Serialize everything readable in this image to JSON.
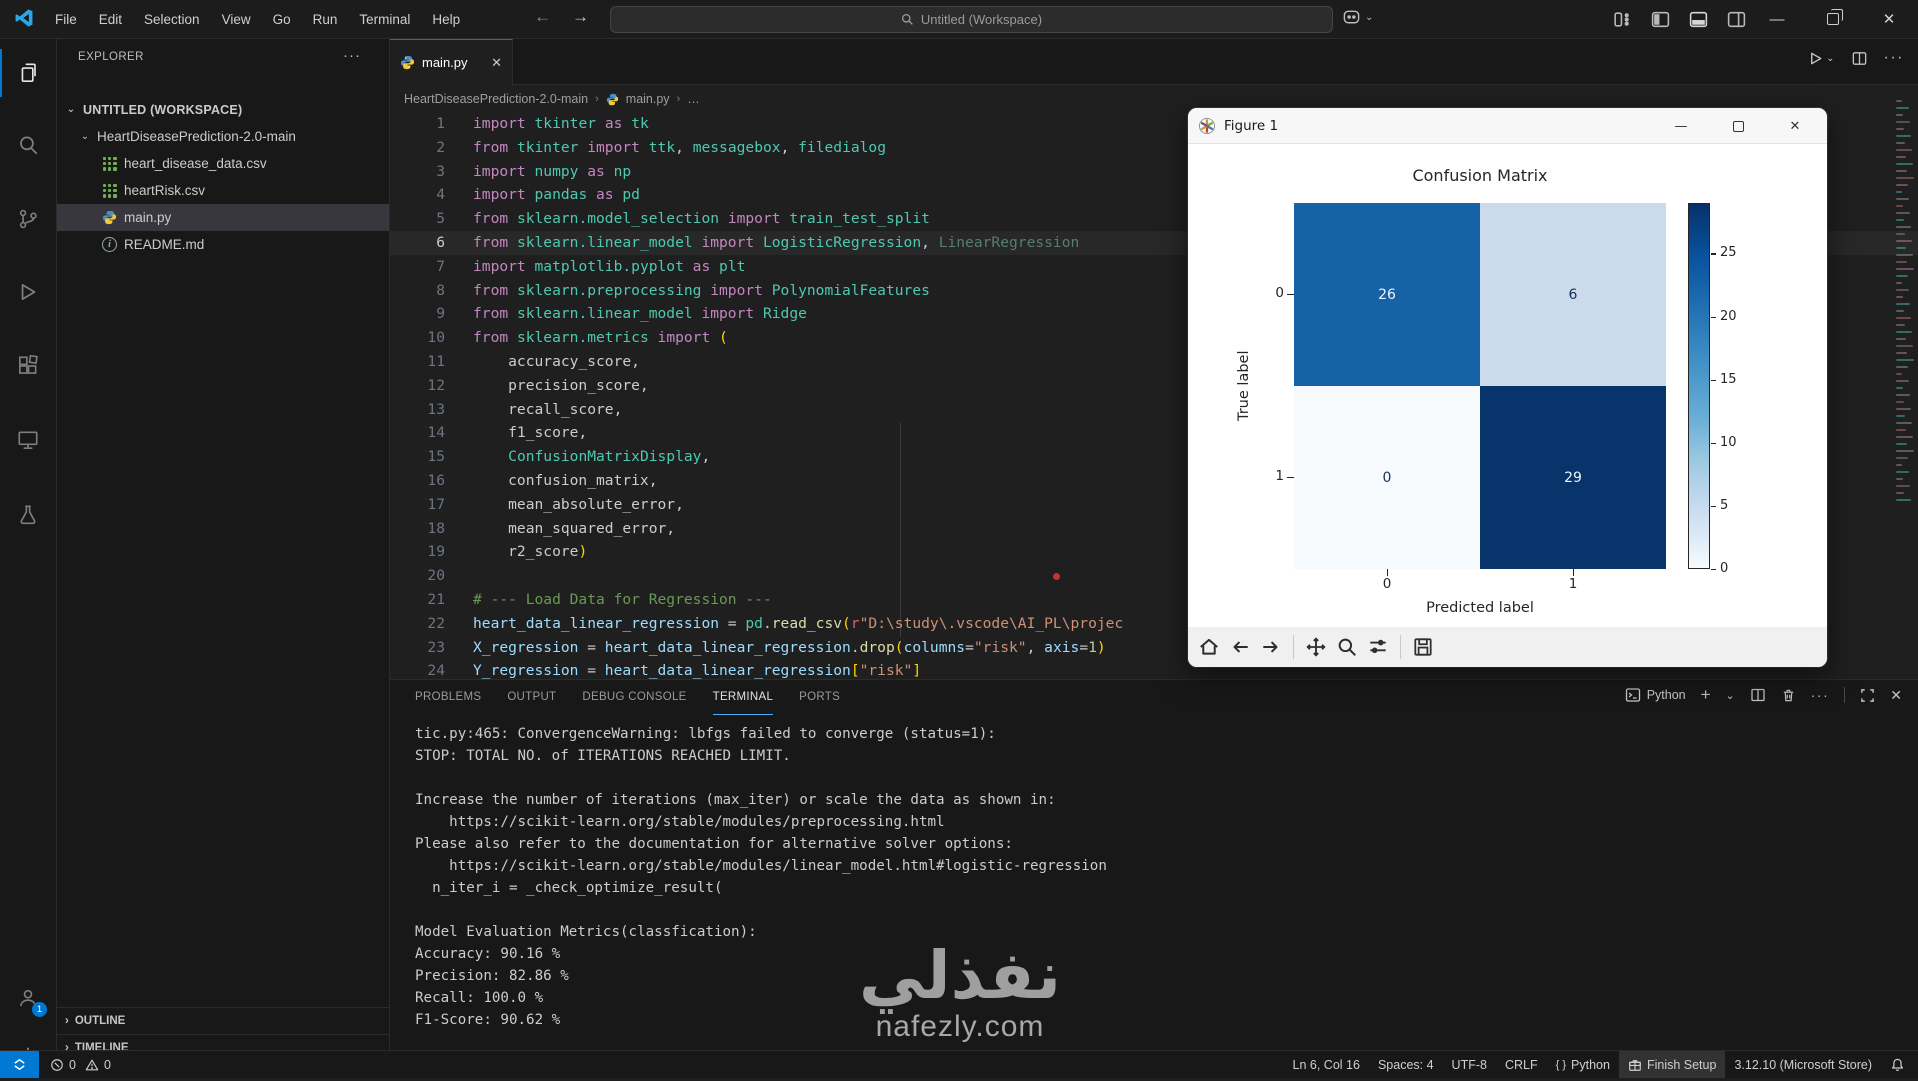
{
  "titlebar": {
    "menus": [
      "File",
      "Edit",
      "Selection",
      "View",
      "Go",
      "Run",
      "Terminal",
      "Help"
    ],
    "search_placeholder": "Untitled (Workspace)"
  },
  "explorer": {
    "title": "EXPLORER",
    "more": "···",
    "workspace_label": "UNTITLED (WORKSPACE)",
    "folder_label": "HeartDiseasePrediction-2.0-main",
    "files": [
      {
        "name": "heart_disease_data.csv",
        "icon": "csv"
      },
      {
        "name": "heartRisk.csv",
        "icon": "csv"
      },
      {
        "name": "main.py",
        "icon": "python",
        "selected": true
      },
      {
        "name": "README.md",
        "icon": "readme"
      }
    ],
    "outline_label": "OUTLINE",
    "timeline_label": "TIMELINE"
  },
  "editor": {
    "tab_label": "main.py",
    "breadcrumb": {
      "folder": "HeartDiseasePrediction-2.0-main",
      "file": "main.py",
      "more": "…"
    },
    "lines": [
      {
        "n": 1,
        "tokens": [
          [
            "import ",
            "k"
          ],
          [
            "tkinter",
            "m"
          ],
          [
            " as ",
            "k"
          ],
          [
            "tk",
            "m"
          ]
        ]
      },
      {
        "n": 2,
        "tokens": [
          [
            "from ",
            "k"
          ],
          [
            "tkinter ",
            "m"
          ],
          [
            "import ",
            "k"
          ],
          [
            "ttk",
            "m"
          ],
          [
            ", ",
            "p"
          ],
          [
            "messagebox",
            "m"
          ],
          [
            ", ",
            "p"
          ],
          [
            "filedialog",
            "m"
          ]
        ]
      },
      {
        "n": 3,
        "tokens": [
          [
            "import ",
            "k"
          ],
          [
            "numpy",
            "m"
          ],
          [
            " as ",
            "k"
          ],
          [
            "np",
            "m"
          ]
        ]
      },
      {
        "n": 4,
        "tokens": [
          [
            "import ",
            "k"
          ],
          [
            "pandas",
            "m"
          ],
          [
            " as ",
            "k"
          ],
          [
            "pd",
            "m"
          ]
        ]
      },
      {
        "n": 5,
        "tokens": [
          [
            "from ",
            "k"
          ],
          [
            "sklearn.model_selection ",
            "m"
          ],
          [
            "import ",
            "k"
          ],
          [
            "train_test_split",
            "m"
          ]
        ]
      },
      {
        "n": 6,
        "current": true,
        "tokens": [
          [
            "from ",
            "k"
          ],
          [
            "sklearn.linear_model ",
            "m"
          ],
          [
            "import ",
            "k"
          ],
          [
            "LogisticRegression",
            "m"
          ],
          [
            ", ",
            "p"
          ],
          [
            "LinearRegression",
            "d"
          ]
        ]
      },
      {
        "n": 7,
        "tokens": [
          [
            "import ",
            "k"
          ],
          [
            "matplotlib.pyplot",
            "m"
          ],
          [
            " as ",
            "k"
          ],
          [
            "plt",
            "m"
          ]
        ]
      },
      {
        "n": 8,
        "tokens": [
          [
            "from ",
            "k"
          ],
          [
            "sklearn.preprocessing ",
            "m"
          ],
          [
            "import ",
            "k"
          ],
          [
            "PolynomialFeatures",
            "m"
          ]
        ]
      },
      {
        "n": 9,
        "tokens": [
          [
            "from ",
            "k"
          ],
          [
            "sklearn.linear_model ",
            "m"
          ],
          [
            "import ",
            "k"
          ],
          [
            "Ridge",
            "m"
          ]
        ]
      },
      {
        "n": 10,
        "tokens": [
          [
            "from ",
            "k"
          ],
          [
            "sklearn.metrics ",
            "m"
          ],
          [
            "import ",
            "k"
          ],
          [
            "(",
            "g"
          ]
        ]
      },
      {
        "n": 11,
        "tokens": [
          [
            "    accuracy_score,",
            "p"
          ]
        ]
      },
      {
        "n": 12,
        "tokens": [
          [
            "    precision_score,",
            "p"
          ]
        ]
      },
      {
        "n": 13,
        "tokens": [
          [
            "    recall_score,",
            "p"
          ]
        ]
      },
      {
        "n": 14,
        "tokens": [
          [
            "    f1_score,",
            "p"
          ]
        ]
      },
      {
        "n": 15,
        "tokens": [
          [
            "    ",
            "p"
          ],
          [
            "ConfusionMatrixDisplay",
            "m"
          ],
          [
            ",",
            "p"
          ]
        ]
      },
      {
        "n": 16,
        "tokens": [
          [
            "    confusion_matrix,",
            "p"
          ]
        ]
      },
      {
        "n": 17,
        "tokens": [
          [
            "    mean_absolute_error,",
            "p"
          ]
        ]
      },
      {
        "n": 18,
        "tokens": [
          [
            "    mean_squared_error,",
            "p"
          ]
        ]
      },
      {
        "n": 19,
        "tokens": [
          [
            "    r2_score",
            "p"
          ],
          [
            ")",
            "g"
          ]
        ]
      },
      {
        "n": 20,
        "tokens": []
      },
      {
        "n": 21,
        "tokens": [
          [
            "# --- Load Data for Regression ---",
            "c"
          ]
        ]
      },
      {
        "n": 22,
        "tokens": [
          [
            "heart_data_linear_regression",
            "v"
          ],
          [
            " = ",
            "p"
          ],
          [
            "pd",
            "m"
          ],
          [
            ".",
            "p"
          ],
          [
            "read_csv",
            "f"
          ],
          [
            "(",
            "g"
          ],
          [
            "r",
            "r2"
          ],
          [
            "\"D:\\study\\.vscode\\AI_PL\\projec",
            "s"
          ]
        ]
      },
      {
        "n": 23,
        "tokens": [
          [
            "X_regression",
            "v"
          ],
          [
            " = ",
            "p"
          ],
          [
            "heart_data_linear_regression",
            "v"
          ],
          [
            ".",
            "p"
          ],
          [
            "drop",
            "f"
          ],
          [
            "(",
            "g"
          ],
          [
            "columns",
            "v"
          ],
          [
            "=",
            "p"
          ],
          [
            "\"risk\"",
            "s"
          ],
          [
            ", ",
            "p"
          ],
          [
            "axis",
            "v"
          ],
          [
            "=",
            "p"
          ],
          [
            "1",
            "n"
          ],
          [
            ")",
            "g"
          ]
        ]
      },
      {
        "n": 24,
        "tokens": [
          [
            "Y_regression",
            "v"
          ],
          [
            " = ",
            "p"
          ],
          [
            "heart_data_linear_regression",
            "v"
          ],
          [
            "[",
            "g"
          ],
          [
            "\"risk\"",
            "s"
          ],
          [
            "]",
            "g"
          ]
        ]
      }
    ]
  },
  "figure": {
    "window_title": "Figure 1",
    "colorbar_ticks": [
      25,
      20,
      15,
      10,
      5,
      0
    ]
  },
  "chart_data": {
    "type": "heatmap",
    "title": "Confusion Matrix",
    "xlabel": "Predicted label",
    "ylabel": "True label",
    "x_categories": [
      "0",
      "1"
    ],
    "y_categories": [
      "0",
      "1"
    ],
    "matrix": [
      [
        26,
        6
      ],
      [
        0,
        29
      ]
    ],
    "colormap": "Blues",
    "colorbar_range": [
      0,
      29
    ],
    "legend_position": "right-colorbar",
    "grid": false
  },
  "terminal": {
    "tabs": [
      "PROBLEMS",
      "OUTPUT",
      "DEBUG CONSOLE",
      "TERMINAL",
      "PORTS"
    ],
    "active_tab": "TERMINAL",
    "shell_label": "Python",
    "lines": [
      "tic.py:465: ConvergenceWarning: lbfgs failed to converge (status=1):",
      "STOP: TOTAL NO. of ITERATIONS REACHED LIMIT.",
      "",
      "Increase the number of iterations (max_iter) or scale the data as shown in:",
      "    https://scikit-learn.org/stable/modules/preprocessing.html",
      "Please also refer to the documentation for alternative solver options:",
      "    https://scikit-learn.org/stable/modules/linear_model.html#logistic-regression",
      "  n_iter_i = _check_optimize_result(",
      "",
      "Model Evaluation Metrics(classfication):",
      "Accuracy: 90.16 %",
      "Precision: 82.86 %",
      "Recall: 100.0 %",
      "F1-Score: 90.62 %"
    ]
  },
  "statusbar": {
    "errors": "0",
    "warnings": "0",
    "line_col": "Ln 6, Col 16",
    "spaces": "Spaces: 4",
    "encoding": "UTF-8",
    "eol": "CRLF",
    "language_icon": "{ }",
    "language": "Python",
    "finish_setup": "Finish Setup",
    "python_version": "3.12.10 (Microsoft Store)"
  },
  "watermark": {
    "arabic": "نفذلي",
    "site": "nafezly.com"
  },
  "colors": {
    "accent": "#0078d4",
    "heat_dark": "#08306b",
    "heat_mid": "#1562a5",
    "heat_light": "#ccdbeb",
    "heat_min": "#f7fbff"
  }
}
